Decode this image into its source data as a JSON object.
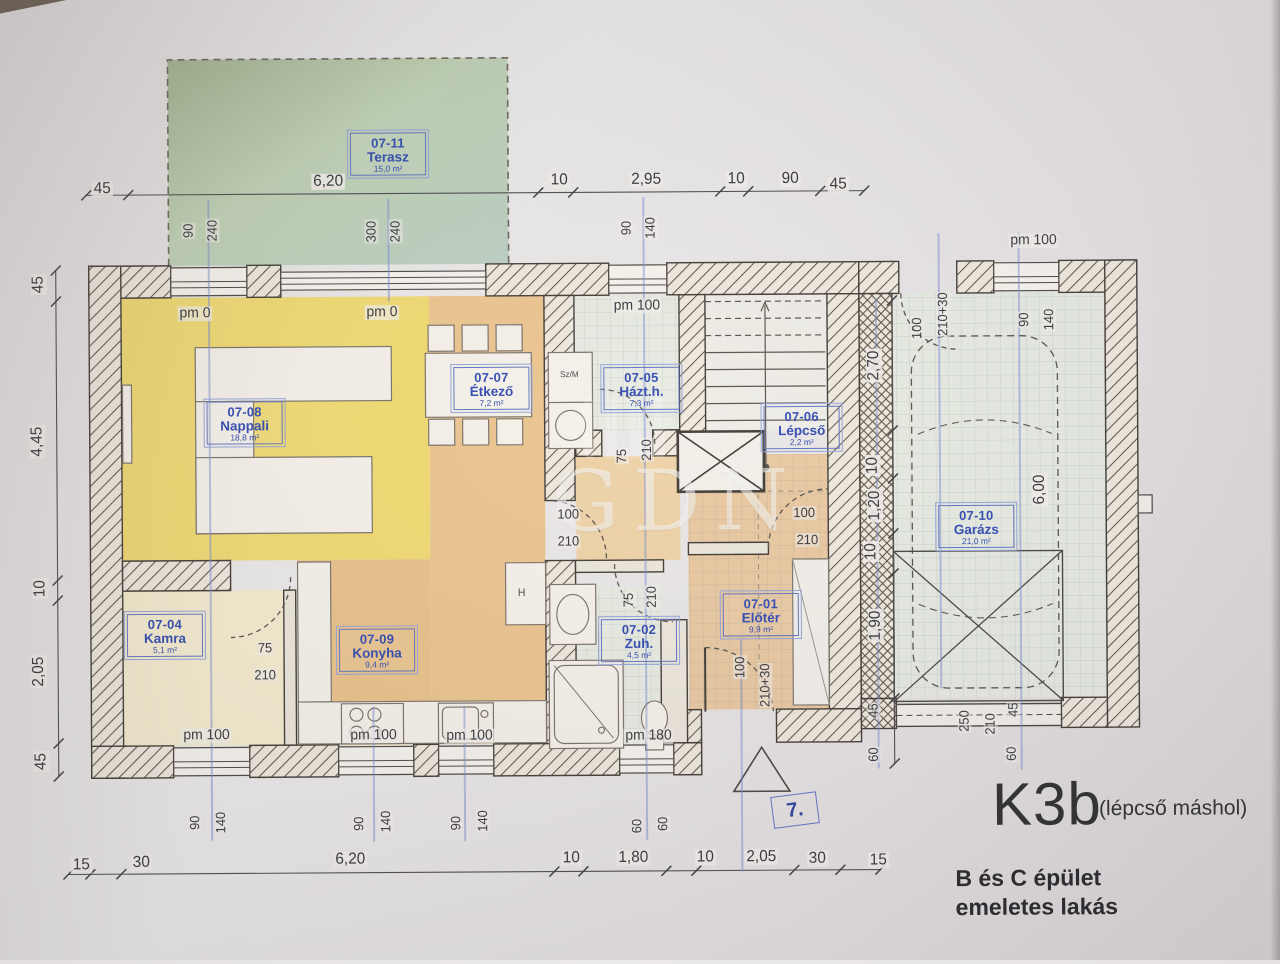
{
  "plan": {
    "code": "K3b",
    "code_note": "(lépcső máshol)",
    "building_line1": "B és C épület",
    "building_line2": "emeletes lakás",
    "watermark": "GDN"
  },
  "rooms": [
    {
      "id": "07-11",
      "name": "Terasz",
      "area": "15,0 m²"
    },
    {
      "id": "07-08",
      "name": "Nappali",
      "area": "18,8 m²"
    },
    {
      "id": "07-07",
      "name": "Étkező",
      "area": "7,2 m²"
    },
    {
      "id": "07-05",
      "name": "Házt.h.",
      "area": "7,3 m²"
    },
    {
      "id": "07-06",
      "name": "Lépcső",
      "area": "2,2 m²"
    },
    {
      "id": "07-04",
      "name": "Kamra",
      "area": "5,1 m²"
    },
    {
      "id": "07-09",
      "name": "Konyha",
      "area": "9,4 m²"
    },
    {
      "id": "07-02",
      "name": "Zuh.",
      "area": "4,5 m²"
    },
    {
      "id": "07-01",
      "name": "Előtér",
      "area": "9,9 m²"
    },
    {
      "id": "07-10",
      "name": "Garázs",
      "area": "21,0 m²"
    }
  ],
  "dims": {
    "top": [
      "45",
      "6,20",
      "10",
      "2,95",
      "10",
      "90",
      "45"
    ],
    "left": [
      "45",
      "4,45",
      "10",
      "2,05",
      "45"
    ],
    "bottom": [
      "15",
      "30",
      "6,20",
      "10",
      "1,80",
      "10",
      "2,05",
      "30",
      "15"
    ],
    "right": [
      "2,70",
      "10",
      "1,20",
      "10",
      "1,90"
    ],
    "piers": [
      "45",
      "60",
      "45",
      "60"
    ],
    "win_top": [
      "90",
      "240",
      "300",
      "240",
      "90",
      "140"
    ],
    "win_bottom": [
      "90",
      "140",
      "90",
      "140",
      "90",
      "140",
      "60",
      "60"
    ],
    "garage_top": [
      "100",
      "210+30",
      "90",
      "140"
    ],
    "garage_depth": [
      "6,00"
    ],
    "garage_door": [
      "250",
      "210"
    ],
    "door_etkezo": [
      "100",
      "210"
    ],
    "door_hall": [
      "100",
      "210"
    ],
    "door_kamra": [
      "75",
      "210"
    ],
    "door_zuh": [
      "75",
      "210"
    ],
    "door_hazth": [
      "75",
      "210"
    ],
    "door_entry": [
      "100",
      "210+30"
    ],
    "pm": [
      "pm 0",
      "pm 0",
      "pm 100",
      "pm 100",
      "pm 100",
      "pm 100",
      "pm 100",
      "pm 180"
    ]
  },
  "misc": {
    "szm": "Sz/M",
    "fridge": "H",
    "entry_badge": "7."
  }
}
